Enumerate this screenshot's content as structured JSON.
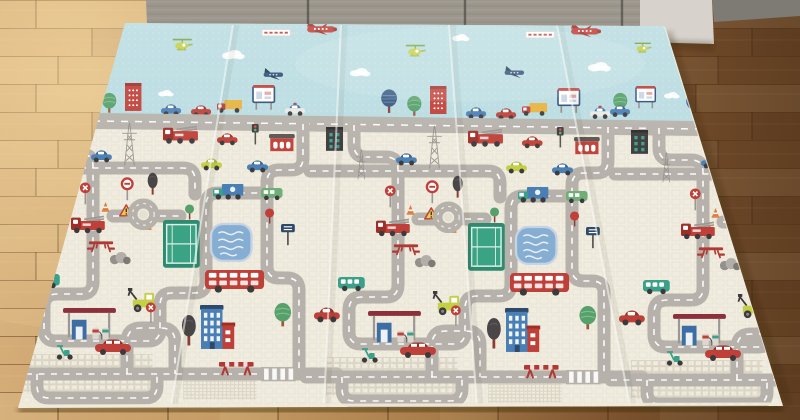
{
  "scene": {
    "alt_text": "Photograph of a large foldable children's play mat with a printed toy road map (roads, cars, buildings, tennis courts, pools, airplanes in a blue sky band) lying unfolded on a warm oak wooden floor in front of a gray wooden cabinet.",
    "objects": [
      "foldable play mat with 5 panels",
      "toy road network print",
      "sky band with red airplanes towing banners",
      "blue airplanes",
      "green helicopters",
      "clouds",
      "trees",
      "buildings",
      "fire trucks",
      "cars",
      "double-decker buses",
      "tennis courts",
      "swimming pools",
      "gas stations",
      "traffic signs",
      "wooden parquet floor",
      "gray cabinet"
    ]
  },
  "palette": {
    "mat_cream": "#f0ecdf",
    "sky_blue": "#b9dce1",
    "road_gray": "#b6b2ab",
    "road_dash": "#ffffff",
    "red": "#bf4038",
    "dark_red": "#9e2f28",
    "blue": "#4a7fb5",
    "navy": "#2f4d76",
    "teal": "#3ba08a",
    "green": "#55a06b",
    "dark": "#3d3a3c",
    "yellow": "#e6b33e",
    "yellow_green": "#c3cf45",
    "orange": "#dd7b3d",
    "pool_blue": "#86aed2",
    "court_green": "#2f8f74",
    "floor_light": "#d4ac77",
    "floor_dark": "#6f4b29",
    "cabinet_gray": "#9c968d",
    "cabinet_light": "#d7d3cc"
  },
  "mat": {
    "panel_count": 5,
    "corners": "125,23 665,26 783,406 18,408",
    "sky_poly": "125,23 665,26 694,121 96,114",
    "city_poly": "96,114 694,121 783,406 18,408",
    "boundary_road_poly": "95,113 700,121 704,136 91,129",
    "boundary_dash": "M93,121 L702,129",
    "seams": [
      [
        171,
        407,
        233,
        25
      ],
      [
        324,
        407,
        341,
        25
      ],
      [
        477,
        406,
        449,
        25
      ],
      [
        630,
        406,
        557,
        25
      ]
    ]
  },
  "cabinet": {
    "dark_poly": "146,0 640,0 640,42 148,48",
    "light_poly": "640,0 712,0 714,44 640,42",
    "baseboard_poly": "712,0 800,0 800,16 714,22 712,0",
    "seams_x": [
      308,
      465,
      622
    ]
  },
  "floor": {
    "highlight_center": [
      90,
      70
    ]
  },
  "sky_items": [
    {
      "t": "cloud",
      "x": 222,
      "y": 50,
      "s": 0.9
    },
    {
      "t": "cloud",
      "x": 350,
      "y": 68,
      "s": 0.8
    },
    {
      "t": "cloud",
      "x": 452,
      "y": 34,
      "s": 0.7
    },
    {
      "t": "cloud",
      "x": 588,
      "y": 62,
      "s": 0.9
    },
    {
      "t": "cloud",
      "x": 158,
      "y": 90,
      "s": 0.6
    },
    {
      "t": "cloud",
      "x": 664,
      "y": 92,
      "s": 0.6
    },
    {
      "t": "heli",
      "x": 172,
      "y": 38
    },
    {
      "t": "heli",
      "x": 405,
      "y": 44
    },
    {
      "t": "heli",
      "x": 634,
      "y": 42,
      "s": 0.85
    },
    {
      "t": "banner",
      "x": 262,
      "y": 28
    },
    {
      "t": "plane-red",
      "x": 304,
      "y": 20
    },
    {
      "t": "banner",
      "x": 526,
      "y": 30
    },
    {
      "t": "plane-red",
      "x": 568,
      "y": 22
    },
    {
      "t": "plane-blue",
      "x": 262,
      "y": 68
    },
    {
      "t": "plane-blue",
      "x": 503,
      "y": 66
    },
    {
      "t": "tree-green",
      "x": 612,
      "y": 92
    },
    {
      "t": "billboard",
      "x": 636,
      "y": 86,
      "s": 0.9
    },
    {
      "t": "car-blue",
      "x": 610,
      "y": 105
    }
  ],
  "repeats": {
    "offsets": [
      {
        "x": 15,
        "dy": 0
      },
      {
        "x": 320,
        "dy": 3
      },
      {
        "x": 625,
        "dy": 6
      }
    ],
    "roads": [
      "M34,122 v20 q0,12 12,12 h20 q12,0 12,12 v116 q0,12 -12,12 h-24 q-13,0 -13,13 v22 q0,12 12,12 h92 q12,0 12,-12 v-24 q0,-12 12,-12 h22 q12,0 12,-12 v-76 q0,-12 12,-12 h44",
      "M-10,168 h178 q12,0 12,12 v14",
      "M98,216 h17 M145,216 h20",
      "M288,124 v34 q0,12 -12,12 h-12 q-12,0 -12,12 v84 q0,12 12,12 h8 q12,0 12,12 v84",
      "M112,374 v-32 q0,-14 14,-14 h20 q14,0 14,14 v32",
      "M-14,374 h336",
      "M22,374 v12 q0,12 12,12 h96 q12,0 12,-12 v-12"
    ],
    "under_items": [
      {
        "t": "patch",
        "x": 6,
        "y": 354
      },
      {
        "t": "patch",
        "x": 168,
        "y": 378,
        "s": 0.55
      }
    ],
    "horizon": [
      {
        "t": "tree-blue",
        "x": 60,
        "y": 86
      },
      {
        "t": "tree-green",
        "x": 86,
        "y": 92
      },
      {
        "t": "bldg-red",
        "x": 110,
        "y": 83
      },
      {
        "t": "car-blue",
        "x": 146,
        "y": 104
      },
      {
        "t": "car-red",
        "x": 176,
        "y": 105
      },
      {
        "t": "truck-yellow",
        "x": 202,
        "y": 100
      },
      {
        "t": "billboard",
        "x": 238,
        "y": 85
      },
      {
        "t": "police",
        "x": 270,
        "y": 104
      }
    ],
    "city": [
      {
        "t": "greenwin",
        "x": 6,
        "y": 124
      },
      {
        "t": "pylon",
        "x": 104,
        "y": 122,
        "s": 0.95
      },
      {
        "t": "pylon",
        "x": 34,
        "y": 146,
        "s": 0.65
      },
      {
        "t": "firetruck",
        "x": 148,
        "y": 126
      },
      {
        "t": "car-red",
        "x": 202,
        "y": 133
      },
      {
        "t": "tlight",
        "x": 236,
        "y": 124
      },
      {
        "t": "red-house",
        "x": 254,
        "y": 134
      },
      {
        "t": "car-blue",
        "x": 76,
        "y": 150
      },
      {
        "t": "car-yg",
        "x": 186,
        "y": 158
      },
      {
        "t": "car-blue",
        "x": 232,
        "y": 160
      },
      {
        "t": "xsign",
        "x": 64,
        "y": 182
      },
      {
        "t": "ringsign",
        "x": 106,
        "y": 178
      },
      {
        "t": "tree-dark",
        "x": 132,
        "y": 172,
        "s": 0.8
      },
      {
        "t": "truck-blue",
        "x": 198,
        "y": 184
      },
      {
        "t": "van-green",
        "x": 246,
        "y": 188
      },
      {
        "t": "lolly-red",
        "x": 250,
        "y": 208
      },
      {
        "t": "lolly-green",
        "x": 170,
        "y": 204
      },
      {
        "t": "signboard",
        "x": 266,
        "y": 224
      },
      {
        "t": "cone",
        "x": 86,
        "y": 202
      },
      {
        "t": "cone",
        "x": 80,
        "y": 218
      },
      {
        "t": "cone",
        "x": 128,
        "y": 220
      },
      {
        "t": "warntri",
        "x": 104,
        "y": 204
      },
      {
        "t": "firetruck",
        "x": 56,
        "y": 216,
        "s": 0.9
      },
      {
        "t": "roundabout",
        "x": 113,
        "y": 199
      },
      {
        "t": "tennis",
        "x": 148,
        "y": 220
      },
      {
        "t": "pool",
        "x": 196,
        "y": 224
      },
      {
        "t": "picnic",
        "x": 72,
        "y": 240
      },
      {
        "t": "rocks",
        "x": 94,
        "y": 252
      },
      {
        "t": "teal-bus",
        "x": 18,
        "y": 274
      },
      {
        "t": "car-red",
        "x": -6,
        "y": 304,
        "s": 1.1
      },
      {
        "t": "bus-red",
        "x": 190,
        "y": 270
      },
      {
        "t": "digger",
        "x": 112,
        "y": 288
      },
      {
        "t": "gas",
        "x": 48,
        "y": 308
      },
      {
        "t": "scooter",
        "x": 40,
        "y": 344
      },
      {
        "t": "car-long",
        "x": 80,
        "y": 338
      },
      {
        "t": "xsign",
        "x": 130,
        "y": 302,
        "s": 0.85
      },
      {
        "t": "tree-dark",
        "x": 166,
        "y": 314
      },
      {
        "t": "bldg-blue",
        "x": 186,
        "y": 304
      },
      {
        "t": "tree-green",
        "x": 258,
        "y": 302
      },
      {
        "t": "barrier",
        "x": 204,
        "y": 360
      },
      {
        "t": "crosswalk",
        "x": 246,
        "y": 367
      }
    ]
  }
}
